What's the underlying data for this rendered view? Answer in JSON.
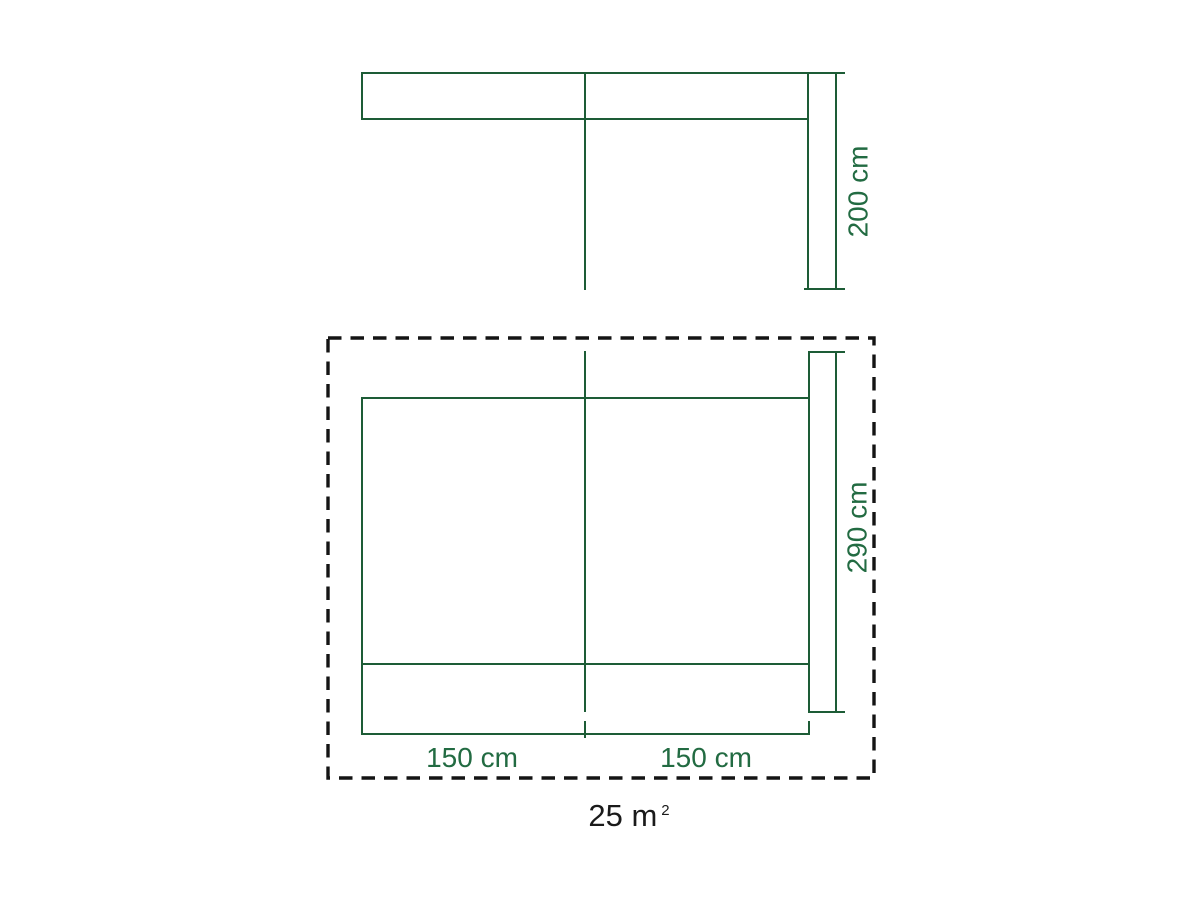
{
  "colors": {
    "line_green": "#1d5c36",
    "label_green": "#226b42",
    "dashed_outline": "#141414",
    "area_text": "#1a1a1a",
    "background": "#ffffff"
  },
  "front_view": {
    "height_label": "200 cm"
  },
  "top_view": {
    "depth_label": "290 cm",
    "left_width_label": "150 cm",
    "right_width_label": "150 cm"
  },
  "area": {
    "value": "25 m",
    "sup": "2"
  }
}
